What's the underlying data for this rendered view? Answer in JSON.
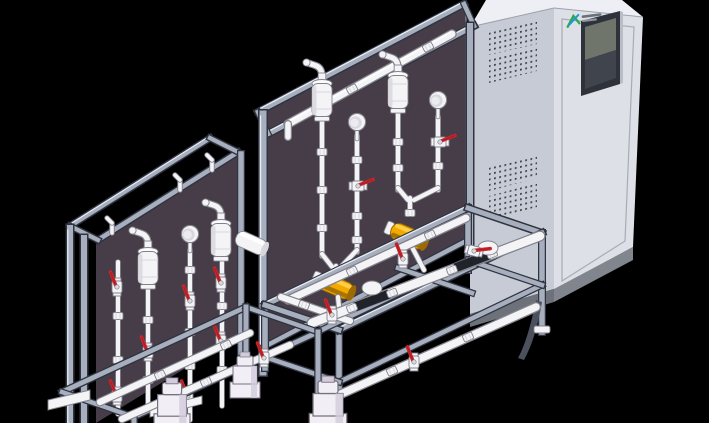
{
  "meta": {
    "title": "3D CAD render: two chemical dosing skid assemblies with an electrical control cabinet",
    "view": "isometric",
    "background": "black"
  },
  "colors": {
    "bg": "#000000",
    "panel": "#463d48",
    "panel_edge": "#8b8194",
    "alu": "#a7afbf",
    "alu_dark": "#2f3440",
    "alu_light": "#e8ecf3",
    "pipe": "#f4f4f6",
    "pipe_outline": "#82828c",
    "pipe_shade": "#d7d7dd",
    "red": "#c9252b",
    "red_dark": "#8e1317",
    "yellow": "#f2a900",
    "yellow_light": "#ffd34d",
    "yellow_dark": "#9c6a00",
    "cab_left": "#c7cbd5",
    "cab_front": "#dde0e7",
    "cab_top": "#edeff4",
    "cab_plinth": "#81858e",
    "cab_plinth_dark": "#6d717a",
    "screen_frame": "#2e333b",
    "screen_upper": "#70756b",
    "screen_lower": "#3f444d",
    "vent_dot": "#3c4049",
    "logo_green": "#2ca84e",
    "logo_blue": "#1d9ad6",
    "pump": "#f1eef5",
    "pump_shade": "#d3cbdc",
    "black_pipe": "#20232a"
  },
  "cabinet": {
    "vent_grids": 4,
    "has_hmi_screen": true,
    "has_brand_logo": true,
    "plinth": true
  },
  "skids": [
    {
      "id": "main-skid",
      "back_panel": "dark purple-grey",
      "components": [
        "pulsation-dampener x2",
        "pressure-gauge x2",
        "red-lever-ball-valves",
        "yellow-flow-cylinder x2",
        "white-manifold-piping",
        "black-pump-sections",
        "aluminium-base-frame",
        "top-rinse-pipe"
      ]
    },
    {
      "id": "left-skid",
      "back_panel": "dark purple-grey",
      "components": [
        "pulsation-dampener x2",
        "pressure-gauge",
        "red-lever-ball-valves",
        "white-roll-cylinder",
        "dosing-pump x3",
        "aluminium-base-frame"
      ]
    }
  ]
}
